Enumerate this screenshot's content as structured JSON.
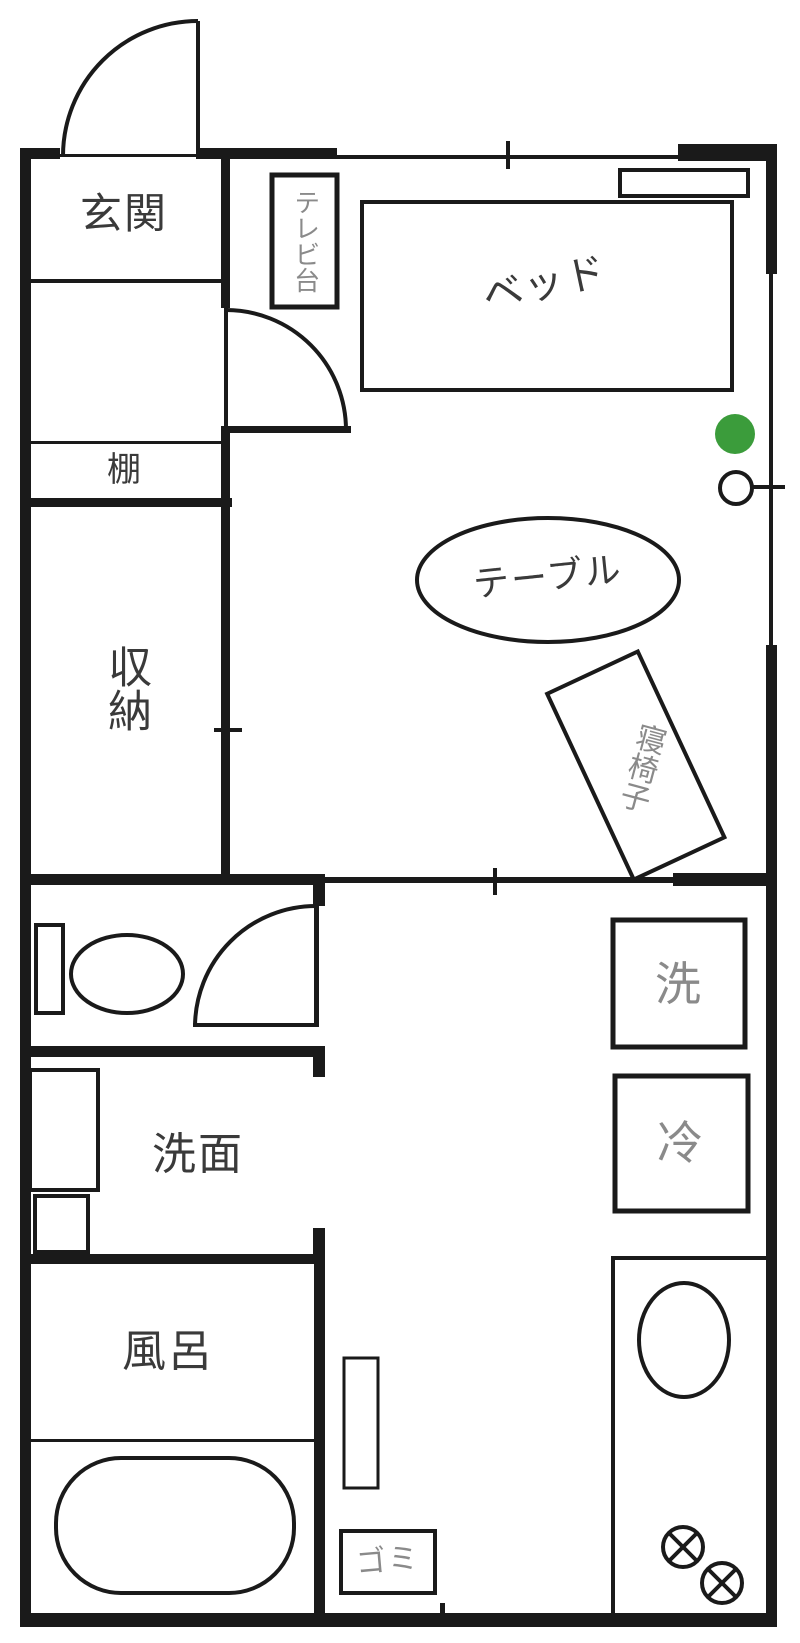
{
  "floorplan": {
    "rooms": {
      "genkan": {
        "label": "玄関"
      },
      "shelf": {
        "label": "棚"
      },
      "storage": {
        "label": "収納"
      },
      "washroom": {
        "label": "洗面"
      },
      "bath": {
        "label": "風呂"
      }
    },
    "furniture": {
      "tv_stand": {
        "label": "テレビ台"
      },
      "bed": {
        "label": "ベッド"
      },
      "table": {
        "label": "テーブル"
      },
      "chaise": {
        "label": "寝椅子"
      },
      "washer": {
        "label": "洗"
      },
      "fridge": {
        "label": "冷"
      },
      "trash": {
        "label": "ゴミ"
      }
    },
    "colors": {
      "line": "#1a1a1a",
      "room_label": "#3a3a3a",
      "furniture_label": "#8a8a8a",
      "green_marker": "#3b9c3b"
    }
  }
}
